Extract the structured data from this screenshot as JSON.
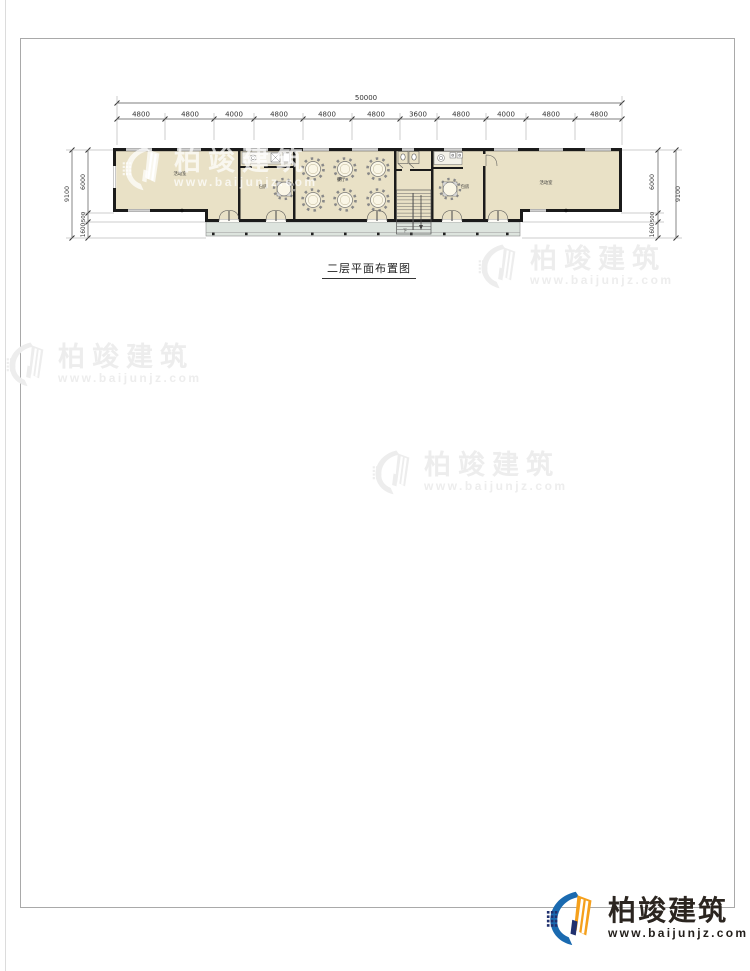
{
  "sheet": {
    "title": "二层平面布置图",
    "stair_label": "下"
  },
  "dims": {
    "top": {
      "total": "50000",
      "segments": [
        "4800",
        "4800",
        "4000",
        "4800",
        "4800",
        "4800",
        "3600",
        "4800",
        "4000",
        "4800",
        "4800"
      ]
    },
    "left": {
      "total": "9100",
      "segments": [
        "6000",
        "500",
        "1600"
      ]
    },
    "right": {
      "total": "9100",
      "segments": [
        "6000",
        "500",
        "1600"
      ]
    }
  },
  "rooms": {
    "hall_left": "活动室",
    "private": "包房",
    "dining": "餐厅",
    "hall_right": "活动室"
  },
  "watermark": {
    "brand": "柏竣建筑",
    "url": "www.baijunjz.com"
  },
  "footer_logo": {
    "brand": "柏竣建筑",
    "url": "www.baijunjz.com",
    "brand_color": "#2b2520",
    "icon_blue": "#1a6ab0",
    "icon_orange": "#f5a01c",
    "icon_navy": "#20306e"
  },
  "colors": {
    "floor": "#e9e1c6",
    "porch": "#dde4de",
    "wall": "#1b1b1b",
    "dim_line": "#555555",
    "watermark_gray": "#ededed"
  }
}
